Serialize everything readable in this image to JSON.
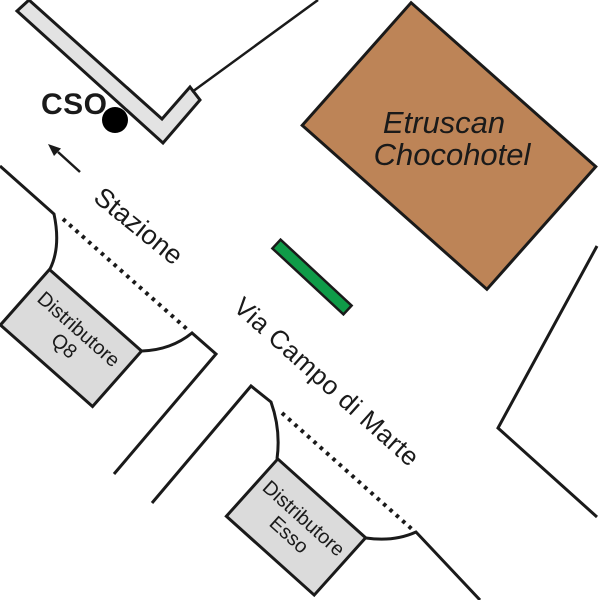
{
  "map": {
    "background_color": "#FFFFFF",
    "stroke_color": "#1A1A1A",
    "colors": {
      "station_building_fill": "#E3E3E3",
      "gas_station_fill": "#DBDBDB",
      "hotel_fill": "#BD8457",
      "green_marker_fill": "#0F9B48",
      "cso_dot_fill": "#000000"
    },
    "labels": {
      "cso": "CSO",
      "stazione": "Stazione",
      "via_campo_di_marte": "Via Campo di Marte",
      "hotel_line1": "Etruscan",
      "hotel_line2": "Chocohotel",
      "q8_line1": "Distributore",
      "q8_line2": "Q8",
      "esso_line1": "Distributore",
      "esso_line2": "Esso"
    }
  }
}
